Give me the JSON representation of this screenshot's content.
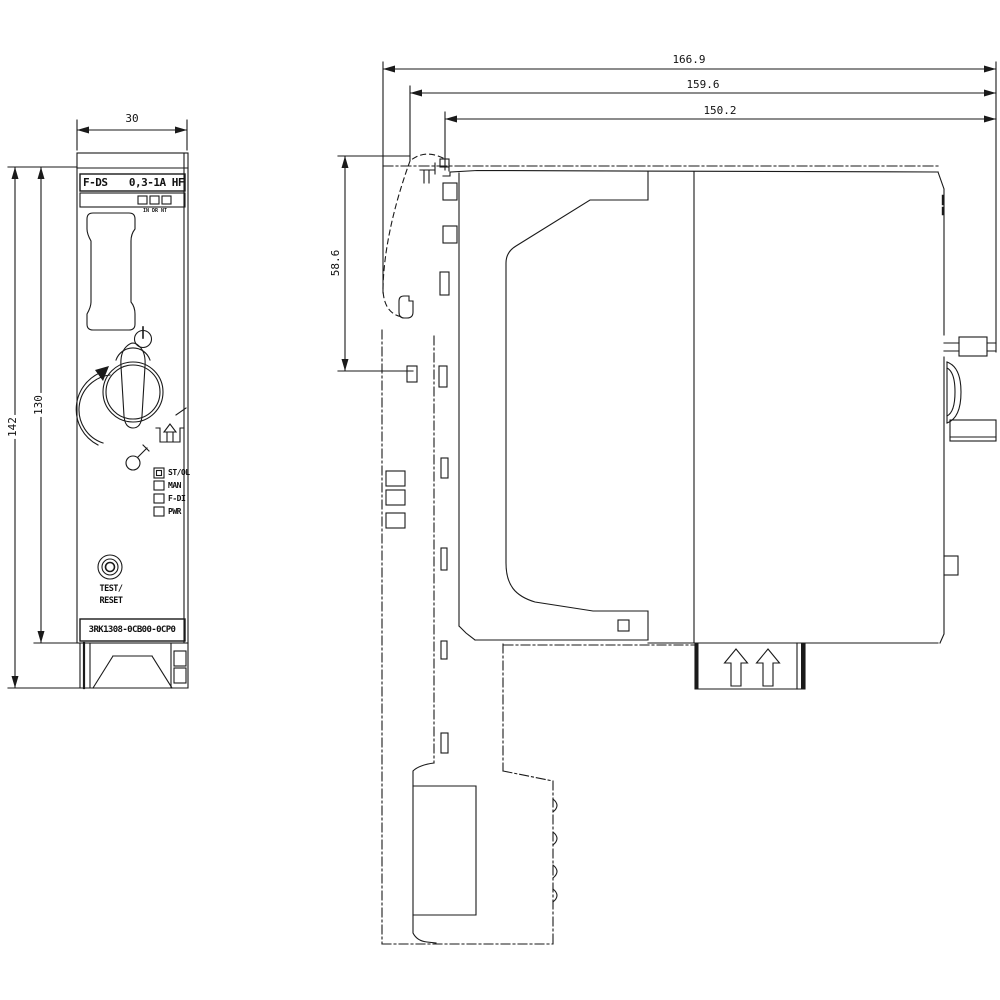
{
  "drawing_title": "Fail-safe direct starter dimension drawing",
  "colors": {
    "line": "#1a1a1a",
    "background": "#ffffff"
  },
  "front_view": {
    "product_label_left": "F-DS",
    "product_label_right": "0,3-1A HF",
    "dip_caption": "IN DR NT",
    "leds": [
      {
        "label": "ST/OL"
      },
      {
        "label": "MAN"
      },
      {
        "label": "F-DI"
      },
      {
        "label": "PWR"
      }
    ],
    "button_line1": "TEST/",
    "button_line2": "RESET",
    "part_number": "3RK1308-0CB00-0CP0",
    "dim_width": "30",
    "dim_height_total": "142",
    "dim_height_body": "130"
  },
  "side_view": {
    "dim_depth_total": "166.9",
    "dim_depth_mid": "159.6",
    "dim_depth_body": "150.2",
    "dim_front_height": "58.6"
  }
}
